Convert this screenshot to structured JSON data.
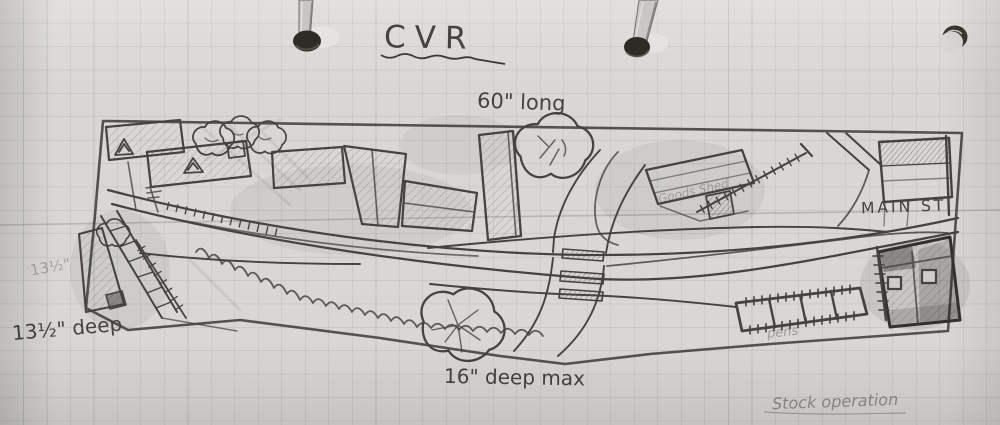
{
  "document": {
    "kind": "hand-drawn model railway track plan sketch on squared paper",
    "title": "CVR"
  },
  "labels": {
    "length": "60\" long",
    "street": "MAIN ST",
    "depth_small": "13½\"",
    "depth": "13½\" deep",
    "depth_max": "16\" deep max",
    "goods_shed": "Goods Shed",
    "pens": "pens",
    "operation_note": "Stock operation"
  },
  "colors": {
    "paper": "#d9d7d4",
    "grid_line": "#a9adb4",
    "pencil": "#45433f",
    "pencil_faint": "#8a8782",
    "hole_dark": "#2e2b27"
  }
}
